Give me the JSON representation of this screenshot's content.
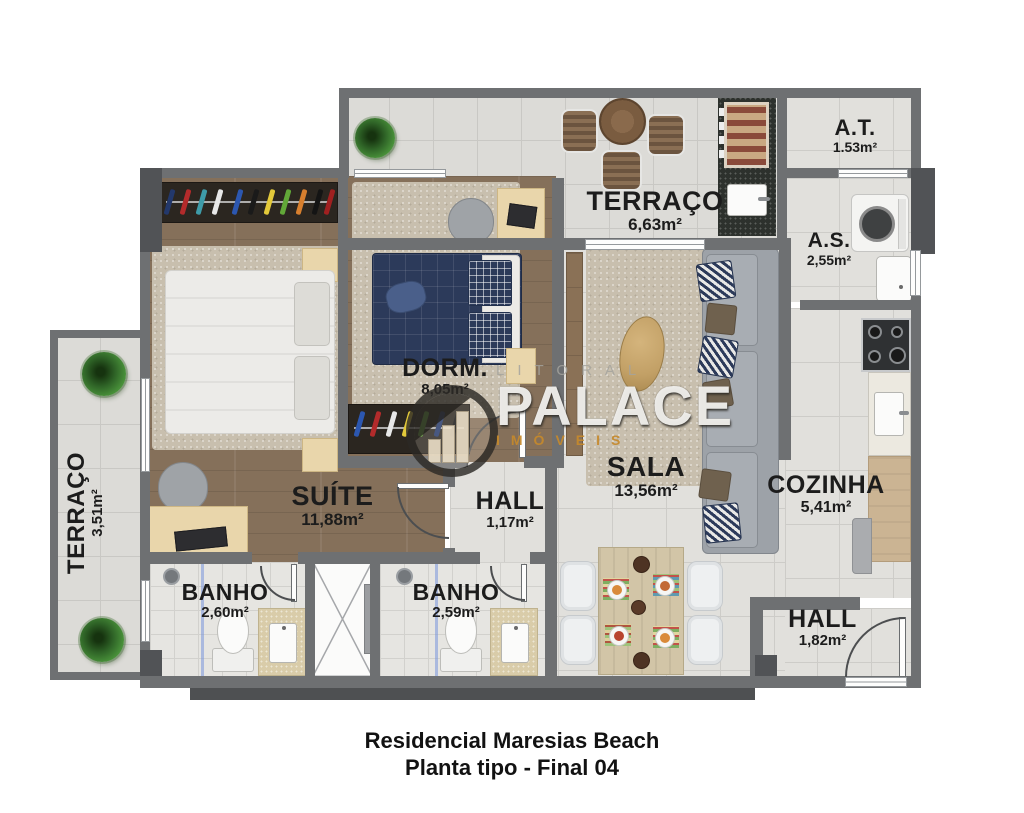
{
  "plan": {
    "caption_line1": "Residencial Maresias Beach",
    "caption_line2": "Planta tipo - Final 04"
  },
  "watermark": {
    "top": "LITORAL",
    "main": "PALACE",
    "bottom": "IMÓVEIS"
  },
  "rooms": {
    "terraco_top": {
      "name": "TERRAÇO",
      "area": "6,63m²"
    },
    "at": {
      "name": "A.T.",
      "area": "1.53m²"
    },
    "as": {
      "name": "A.S.",
      "area": "2,55m²"
    },
    "dorm": {
      "name": "DORM.",
      "area": "8,05m²"
    },
    "sala": {
      "name": "SALA",
      "area": "13,56m²"
    },
    "cozinha": {
      "name": "COZINHA",
      "area": "5,41m²"
    },
    "suite": {
      "name": "SUÍTE",
      "area": "11,88m²"
    },
    "hall1": {
      "name": "HALL",
      "area": "1,17m²"
    },
    "banho_suite": {
      "name": "BANHO",
      "area": "2,60m²"
    },
    "banho_social": {
      "name": "BANHO",
      "area": "2,59m²"
    },
    "hall_entrada": {
      "name": "HALL",
      "area": "1,82m²"
    },
    "terraco_left": {
      "name": "TERRAÇO",
      "area": "3,51m²"
    }
  },
  "colors": {
    "wall": "#6e7072",
    "accent_orange": "#c68a2b",
    "navy": "#2c3a5a",
    "wood": "#85705a"
  }
}
